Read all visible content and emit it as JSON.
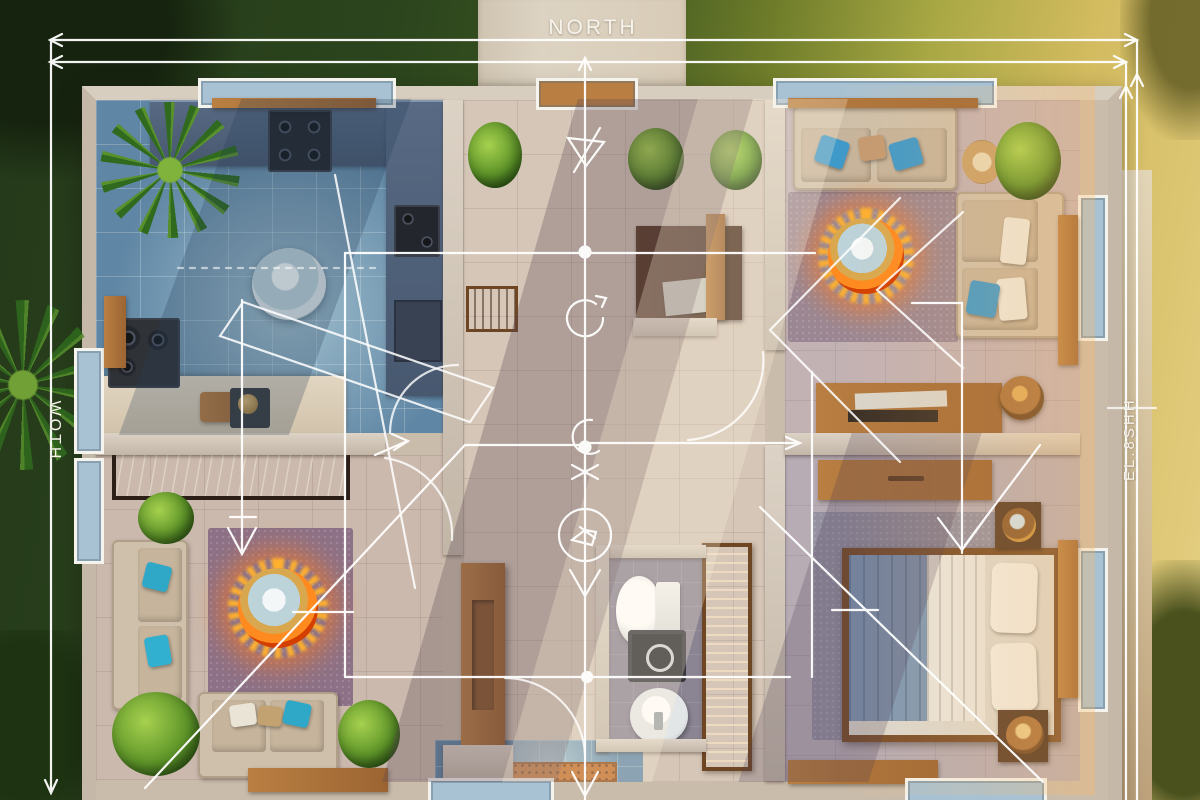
{
  "labels": {
    "north": "NORTH",
    "west_dimension": "WOTH",
    "east_dimension": "EL.8SHH"
  },
  "palette": {
    "annotation_white": "#ffffff",
    "grass_dark": "#2c431c",
    "grass_sunlit_gold": "#dcc26a",
    "path_beige": "#d9cec0",
    "wall_beige": "#cfc4b7",
    "kitchen_tile_blue": "#5f86a4",
    "counter_slate": "#4b5c74",
    "hall_tile_beige": "#d5c6b7",
    "living_rug_mauve": "#8d7186",
    "bedroom_rug_gray": "#9490a0",
    "sofa_beige": "#cfc0ab",
    "pillow_teal": "#2fa8c8",
    "wood_brown": "#a9713c",
    "fire_glow_orange": "#ff8a1f",
    "bed_blanket_blue": "#7f98b4"
  },
  "scene": {
    "type": "aerial-3d-floor-plan-render",
    "rooms": [
      "kitchen",
      "living-room",
      "hallway",
      "bathroom",
      "sitting-room",
      "bedroom",
      "entry"
    ],
    "annotation_symbols": [
      "dimension-arrow",
      "north-up-arrow",
      "section-triangle",
      "rotation-arrow",
      "center-node",
      "door-swing-arc",
      "down-arrow",
      "circle-detail-icon",
      "asterisk-mark"
    ]
  }
}
